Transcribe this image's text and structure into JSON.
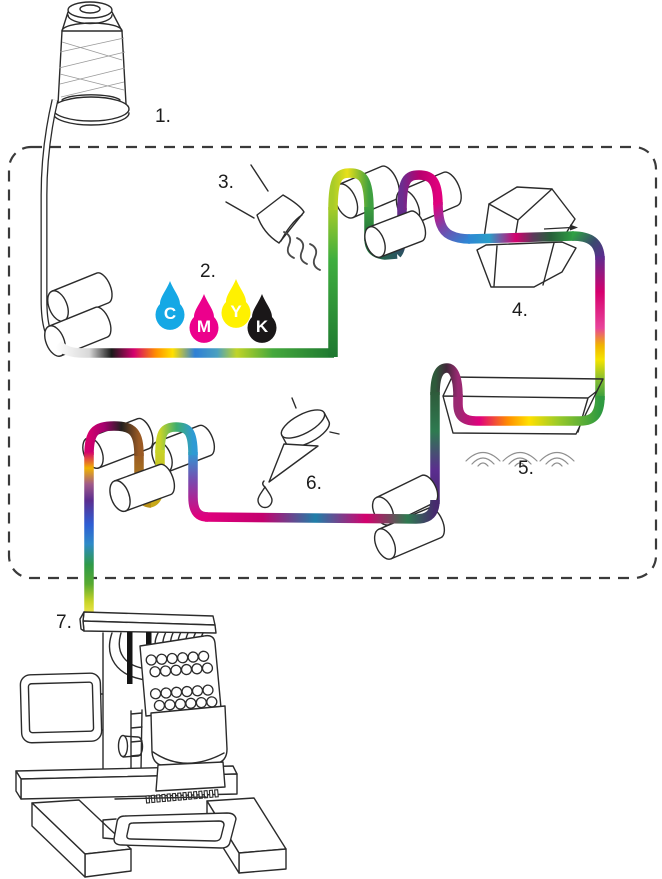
{
  "diagram": {
    "background": "#ffffff",
    "outline_color": "#2b2b2b",
    "step_labels": {
      "s1": "1.",
      "s2": "2.",
      "s3": "3.",
      "s4": "4.",
      "s5": "5.",
      "s6": "6.",
      "s7": "7."
    },
    "cmyk": {
      "letter_color": "#ffffff",
      "drops": [
        {
          "letter": "C",
          "color": "#15A8E5"
        },
        {
          "letter": "M",
          "color": "#EC008C"
        },
        {
          "letter": "Y",
          "color": "#FFF100"
        },
        {
          "letter": "K",
          "color": "#1A1718"
        }
      ]
    },
    "thread_palette": [
      "#FFFFFF",
      "#141414",
      "#E0007D",
      "#FF8C00",
      "#FFE000",
      "#2E7FD6",
      "#2FA044",
      "#6B2D8F",
      "#C8D428"
    ]
  }
}
